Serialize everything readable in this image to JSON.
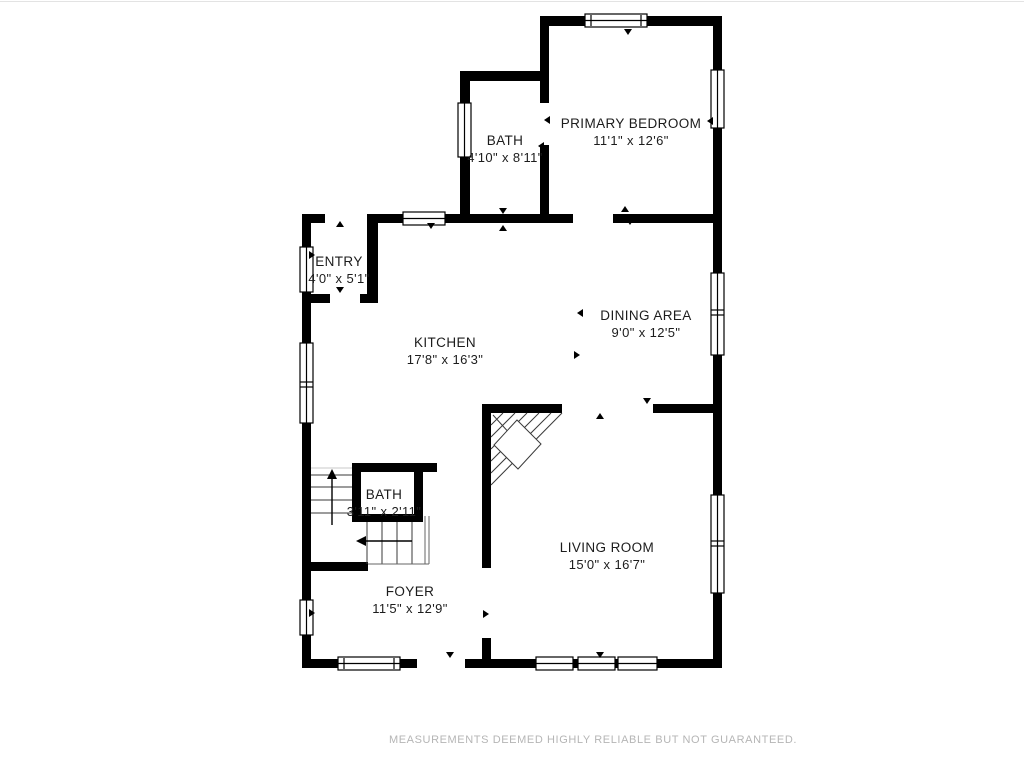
{
  "page": {
    "background": "#ffffff",
    "top_border_color": "#e3e3e3"
  },
  "floorplan": {
    "wall_color": "#000000",
    "label_color": "#1c1c1c",
    "rooms": [
      {
        "id": "primary-bedroom",
        "name": "PRIMARY BEDROOM",
        "dims": "11'1\" x 12'6\""
      },
      {
        "id": "bath-upper",
        "name": "BATH",
        "dims": "4'10\" x 8'11\""
      },
      {
        "id": "entry",
        "name": "ENTRY",
        "dims": "4'0\" x 5'1\""
      },
      {
        "id": "kitchen",
        "name": "KITCHEN",
        "dims": "17'8\" x 16'3\""
      },
      {
        "id": "dining-area",
        "name": "DINING AREA",
        "dims": "9'0\" x 12'5\""
      },
      {
        "id": "bath-lower",
        "name": "BATH",
        "dims": "3'11\" x 2'11\""
      },
      {
        "id": "living-room",
        "name": "LIVING ROOM",
        "dims": "15'0\" x 16'7\""
      },
      {
        "id": "foyer",
        "name": "FOYER",
        "dims": "11'5\" x 12'9\""
      }
    ]
  },
  "footer": {
    "disclaimer": "MEASUREMENTS DEEMED HIGHLY RELIABLE BUT NOT GUARANTEED.",
    "color": "#b5b5b5"
  }
}
